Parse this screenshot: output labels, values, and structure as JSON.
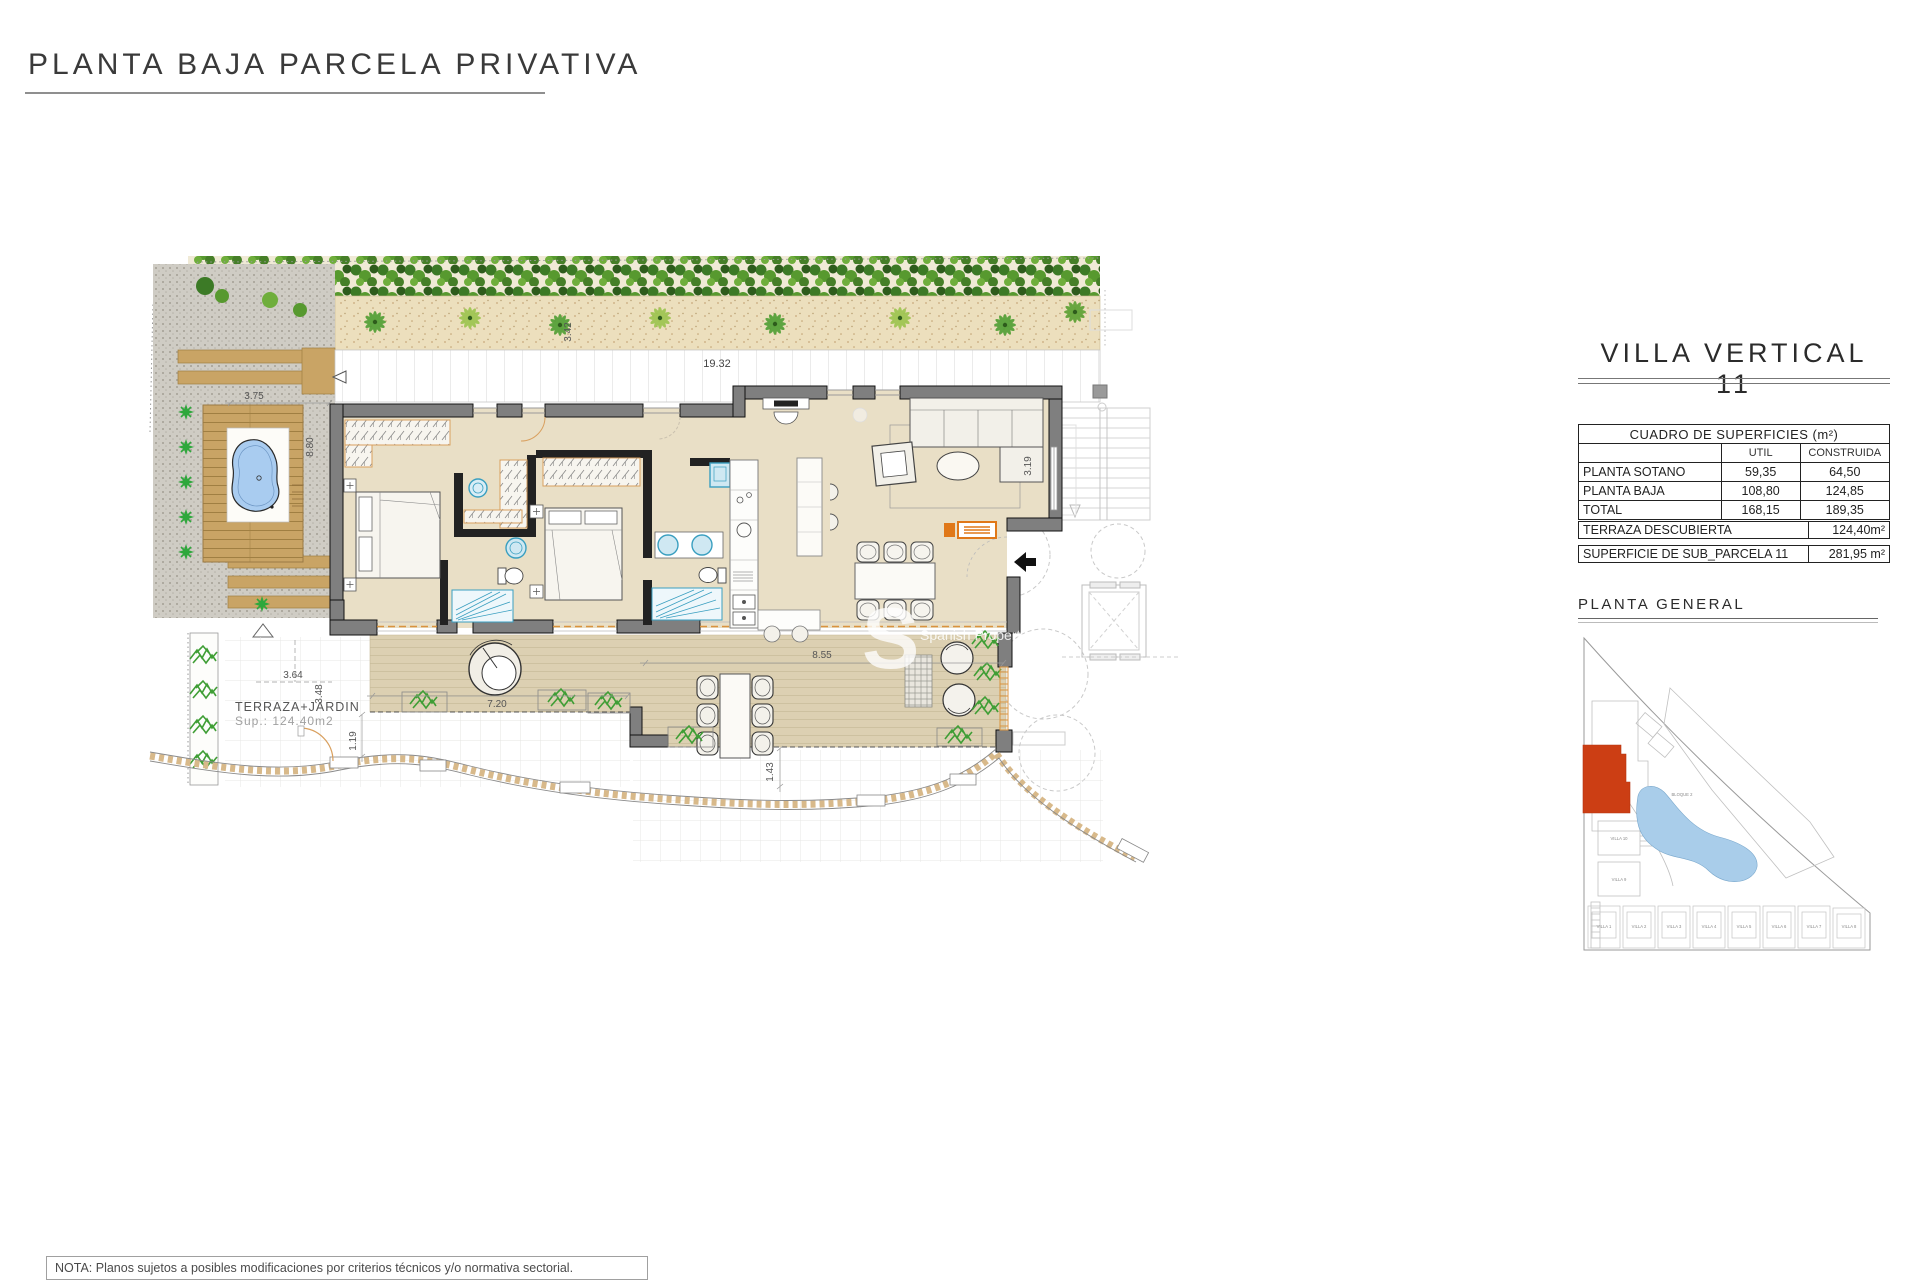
{
  "page": {
    "title": "PLANTA BAJA PARCELA PRIVATIVA",
    "note": "NOTA: Planos sujetos a posibles modificaciones por criterios técnicos y/o normativa sectorial."
  },
  "panel": {
    "title": "VILLA VERTICAL 11",
    "surfaces": {
      "header": "CUADRO DE SUPERFICIES (m²)",
      "col_util": "UTIL",
      "col_construida": "CONSTRUIDA",
      "rows": [
        {
          "label": "PLANTA SOTANO",
          "util": "59,35",
          "construida": "64,50"
        },
        {
          "label": "PLANTA BAJA",
          "util": "108,80",
          "construida": "124,85"
        },
        {
          "label": "TOTAL",
          "util": "168,15",
          "construida": "189,35"
        }
      ]
    },
    "terraza": {
      "label": "TERRAZA DESCUBIERTA",
      "value": "124,40m²"
    },
    "subparcela": {
      "label": "SUPERFICIE DE SUB_PARCELA 11",
      "value": "281,95 m²"
    },
    "planta_general_label": "PLANTA GENERAL",
    "thumb": {
      "bloque2": "BLOQUE 2",
      "villa10": "VILLA 10",
      "villa9": "VILLA 9",
      "villas": [
        "VILLA 1",
        "VILLA 2",
        "VILLA 3",
        "VILLA 4",
        "VILLA 5",
        "VILLA 6",
        "VILLA 7",
        "VILLA 8"
      ],
      "highlight_color": "#cc3e14"
    }
  },
  "plan": {
    "labels": {
      "terraza_jardin": "TERRAZA+JARDIN",
      "terraza_sup": "Sup.: 124.40m2"
    },
    "dims": {
      "d1932": "19.32",
      "d342": "3.42",
      "d375": "3.75",
      "d880": "8.80",
      "d364": "3.64",
      "d348": "3.48",
      "d119": "1.19",
      "d720": "7.20",
      "d855": "8.55",
      "d143": "1.43",
      "d319": "3.19"
    },
    "watermark": {
      "big": "S",
      "line1": "Spanish Property"
    },
    "colors": {
      "floor": "#e9dfc6",
      "terrace": "#dcd0b2",
      "wall": "#7f7f7f",
      "pool": "#a9ccf0",
      "accent_orange": "#e07818",
      "fixture_blue": "#3a9fc0"
    }
  }
}
